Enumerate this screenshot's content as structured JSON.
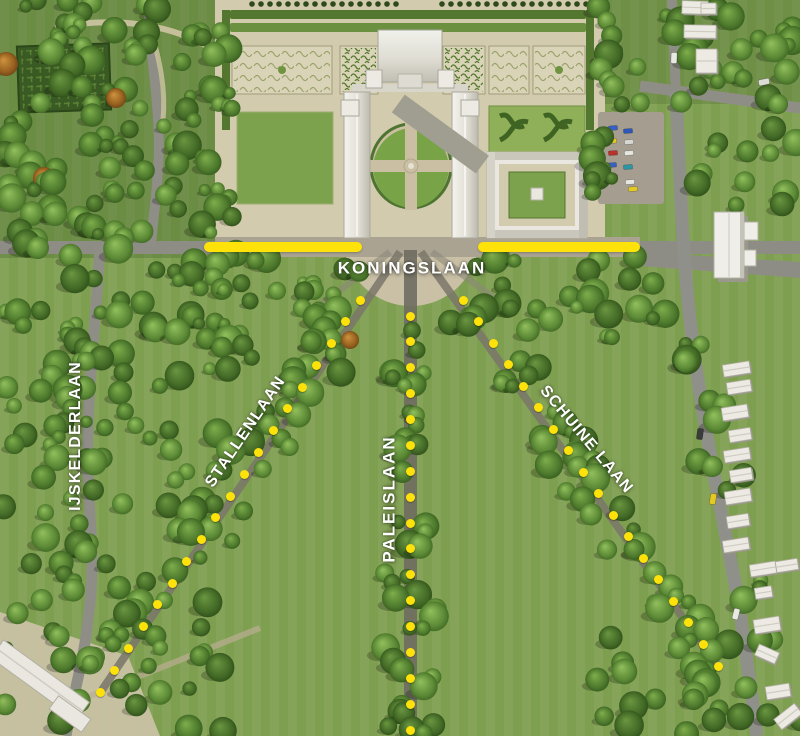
{
  "map": {
    "name": "palace-park-aerial-map",
    "highlight_color": "#ffe20a",
    "label_color": "#ffffff",
    "labels": [
      {
        "id": "koningslaan",
        "text": "KONINGSLAAN",
        "x": 412,
        "y": 268,
        "angle": 0,
        "big": true
      },
      {
        "id": "ijskelderlaan",
        "text": "IJSKELDERLAAN",
        "x": 76,
        "y": 436,
        "angle": -90,
        "big": false
      },
      {
        "id": "stallenlaan",
        "text": "STALLENLAAN",
        "x": 246,
        "y": 432,
        "angle": -56,
        "big": false
      },
      {
        "id": "paleislaan",
        "text": "PALEISLAAN",
        "x": 389,
        "y": 499,
        "angle": -90,
        "big": true
      },
      {
        "id": "schuine-laan",
        "text": "SCHUINE LAAN",
        "x": 586,
        "y": 440,
        "angle": 50,
        "big": false
      }
    ],
    "solid_lines": [
      {
        "id": "koningslaan-highlight-left",
        "x1": 204,
        "y1": 247,
        "x2": 362,
        "y2": 247
      },
      {
        "id": "koningslaan-highlight-right",
        "x1": 478,
        "y1": 247,
        "x2": 640,
        "y2": 247
      }
    ],
    "dotted_lines": [
      {
        "id": "route-stallenlaan",
        "x1": 360,
        "y1": 300,
        "x2": 100,
        "y2": 692,
        "dots": 19
      },
      {
        "id": "route-paleislaan",
        "x1": 410,
        "y1": 316,
        "x2": 410,
        "y2": 730,
        "dots": 17
      },
      {
        "id": "route-schuine-laan",
        "x1": 463,
        "y1": 300,
        "x2": 718,
        "y2": 666,
        "dots": 18
      }
    ]
  }
}
